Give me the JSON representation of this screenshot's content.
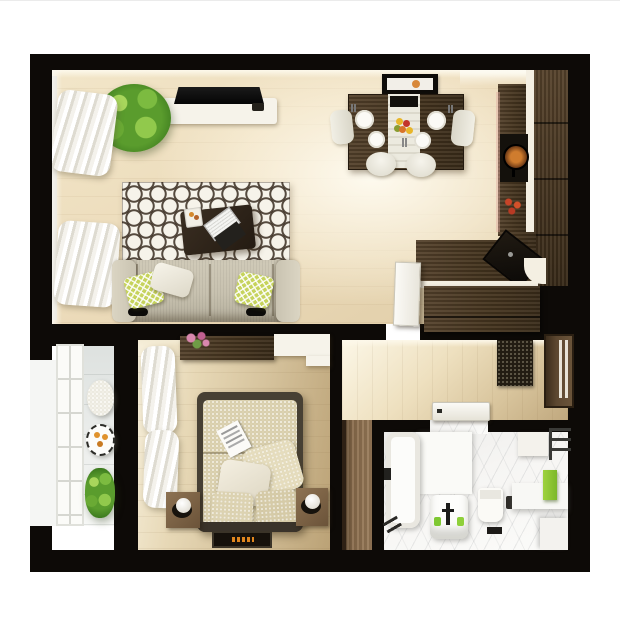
{
  "scene": {
    "kind": "3d-rendered apartment floor plan, top-down view",
    "plan_margins": {
      "left_px": 30,
      "top_px": 54,
      "right_px": 30,
      "bottom_px": 46
    },
    "wall_color": "#0d0a07",
    "page_background": "#ffffff"
  },
  "palette": {
    "wood_floor_light": "#ecdbba",
    "wood_floor_bedroom": "#d5c29c",
    "wood_furniture_dark": "#46351f",
    "wood_furniture_medium": "#8a6c4c",
    "white_furniture": "#f6f3ea",
    "sofa_fabric": "#c7c1af",
    "pillow_green": "#c6d35c",
    "plant_green": "#5a9c2d",
    "rug_pattern_dark": "#382c20",
    "balcony_tile": "#eceeec",
    "bathroom_marble": "#f6f5f3",
    "towel_green": "#8fc832",
    "accent_orange": "#e08a2a"
  },
  "rooms": {
    "living_room": {
      "name": "living room",
      "furniture": [
        "potted-plant",
        "wall-tv",
        "tv-console",
        "window-curtains",
        "patterned-rug",
        "coffee-table",
        "laptop",
        "serving-tray",
        "three-seat-sofa",
        "green-throw-pillows",
        "white-throw-pillow"
      ]
    },
    "dining_area": {
      "name": "dining area",
      "furniture": [
        "dining-table",
        "table-runner",
        "fruit-bowl",
        "four-plates",
        "four-chairs",
        "wall-picture"
      ]
    },
    "kitchen": {
      "name": "kitchen",
      "furniture": [
        "l-shaped-counter",
        "tall-cabinet-column",
        "cooktop-with-pan",
        "chili-peppers",
        "corner-sink",
        "white-countertop-trim"
      ]
    },
    "hallway": {
      "name": "entry hall",
      "furniture": [
        "built-in-closet",
        "open-white-door",
        "doormat",
        "front-door",
        "bathroom-door",
        "tall-wardrobe"
      ]
    },
    "bedroom": {
      "name": "bedroom",
      "furniture": [
        "double-bed",
        "duvet",
        "magazine",
        "pillows",
        "headboard",
        "left-nightstand",
        "right-nightstand",
        "two-lamps",
        "dresser-with-flowers",
        "white-desk",
        "window-curtains",
        "dark-rug-with-orange-logo"
      ]
    },
    "balcony": {
      "name": "balcony",
      "furniture": [
        "french-window",
        "wicker-pouf",
        "round-tray-table",
        "oranges",
        "potted-bush"
      ]
    },
    "bathroom": {
      "name": "bathroom",
      "furniture": [
        "bathtub",
        "shower-fixture",
        "vanity-sink",
        "black-faucet",
        "green-soap-bottles",
        "toilet",
        "wall-button",
        "green-towel",
        "towel-radiator",
        "wall-cabinet",
        "corner-counter",
        "bath-mat"
      ]
    }
  }
}
